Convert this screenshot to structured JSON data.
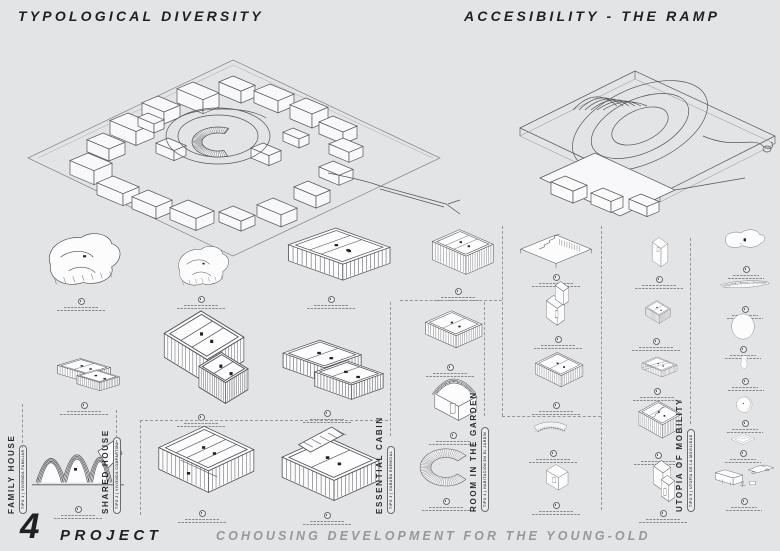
{
  "page": {
    "background": "#e3e4e6",
    "ink": "#1f2023",
    "muted": "#97989c",
    "line": "#54555a"
  },
  "header": {
    "left_title": "TYPOLOGICAL DIVERSITY",
    "right_title": "ACCESIBILITY - THE RAMP"
  },
  "panels": [
    {
      "name": "site-axonometric"
    },
    {
      "name": "ramp-axonometric"
    }
  ],
  "typologies": [
    {
      "label": "FAMILY HOUSE",
      "sub": "TIPO 1 | VIVIENDA FAMILIAR"
    },
    {
      "label": "SHARED HOUSE",
      "sub": "TIPO 2 | VIVIENDA COMPARTIDA"
    },
    {
      "label": "ESSENTIAL CABIN",
      "sub": "TIPO 3 | CABAÑA ESENCIAL"
    },
    {
      "label": "ROOM IN THE GARDEN",
      "sub": "TIPO 4 | HABITACIÓN EN EL JARDÍN"
    },
    {
      "label": "UTOPIA OF MOBILITY",
      "sub": "TIPO 5 | UTOPÍA DE LA MOVILIDAD"
    }
  ],
  "figures": [
    {
      "kind": "blob",
      "x": 30,
      "y": 228,
      "w": 102,
      "h": 68
    },
    {
      "kind": "lwall",
      "x": 40,
      "y": 356,
      "w": 88,
      "h": 44
    },
    {
      "kind": "curvedRoof",
      "x": 28,
      "y": 420,
      "w": 100,
      "h": 84
    },
    {
      "kind": "blob",
      "x": 165,
      "y": 242,
      "w": 72,
      "h": 52
    },
    {
      "kind": "roomT",
      "x": 150,
      "y": 308,
      "w": 102,
      "h": 104
    },
    {
      "kind": "roomBig",
      "x": 148,
      "y": 424,
      "w": 108,
      "h": 84
    },
    {
      "kind": "roomOpen",
      "x": 272,
      "y": 224,
      "w": 118,
      "h": 70
    },
    {
      "kind": "roomL",
      "x": 266,
      "y": 336,
      "w": 122,
      "h": 72
    },
    {
      "kind": "roomRamp",
      "x": 268,
      "y": 422,
      "w": 118,
      "h": 88
    },
    {
      "kind": "hatchBox",
      "x": 418,
      "y": 228,
      "w": 80,
      "h": 58
    },
    {
      "kind": "roomS",
      "x": 412,
      "y": 306,
      "w": 76,
      "h": 56
    },
    {
      "kind": "archCabin",
      "x": 418,
      "y": 368,
      "w": 70,
      "h": 62
    },
    {
      "kind": "cArc",
      "x": 410,
      "y": 446,
      "w": 72,
      "h": 50
    },
    {
      "kind": "stairHatch",
      "x": 514,
      "y": 222,
      "w": 84,
      "h": 50
    },
    {
      "kind": "towerBox",
      "x": 536,
      "y": 280,
      "w": 44,
      "h": 54
    },
    {
      "kind": "roomS",
      "x": 524,
      "y": 348,
      "w": 64,
      "h": 52
    },
    {
      "kind": "bench",
      "x": 528,
      "y": 418,
      "w": 50,
      "h": 30
    },
    {
      "kind": "cube",
      "x": 536,
      "y": 460,
      "w": 40,
      "h": 40
    },
    {
      "kind": "tallBox",
      "x": 642,
      "y": 234,
      "w": 34,
      "h": 40
    },
    {
      "kind": "openBox",
      "x": 636,
      "y": 296,
      "w": 40,
      "h": 40
    },
    {
      "kind": "wedge",
      "x": 632,
      "y": 352,
      "w": 50,
      "h": 34
    },
    {
      "kind": "stairRoom",
      "x": 630,
      "y": 398,
      "w": 56,
      "h": 52
    },
    {
      "kind": "lBox",
      "x": 642,
      "y": 456,
      "w": 42,
      "h": 52
    },
    {
      "kind": "cloud",
      "x": 716,
      "y": 228,
      "w": 60,
      "h": 36
    },
    {
      "kind": "boat",
      "x": 716,
      "y": 278,
      "w": 58,
      "h": 26
    },
    {
      "kind": "circleIcon",
      "x": 722,
      "y": 310,
      "w": 42,
      "h": 34
    },
    {
      "kind": "pouch",
      "x": 736,
      "y": 354,
      "w": 18,
      "h": 22
    },
    {
      "kind": "head",
      "x": 728,
      "y": 392,
      "w": 34,
      "h": 26
    },
    {
      "kind": "card",
      "x": 726,
      "y": 430,
      "w": 34,
      "h": 18
    },
    {
      "kind": "vehicles",
      "x": 710,
      "y": 462,
      "w": 68,
      "h": 34
    }
  ],
  "footer": {
    "project_number": "4",
    "project_label": "PROJECT",
    "subtitle": "COHOUSING DEVELOPMENT FOR THE YOUNG-OLD"
  }
}
